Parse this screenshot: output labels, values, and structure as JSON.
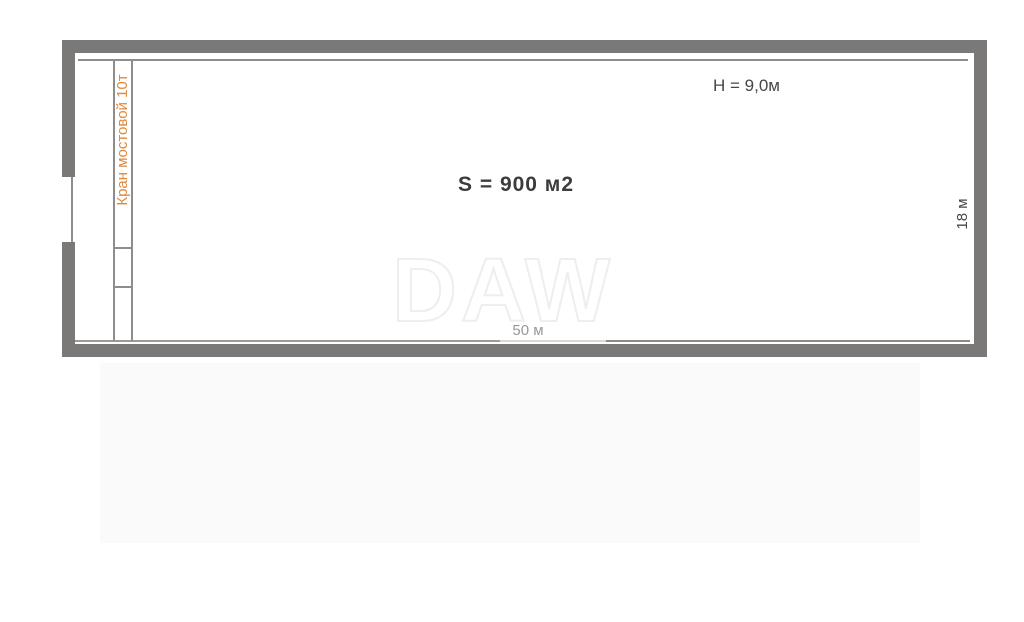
{
  "plan": {
    "crane_label": "Кран мостовой 10т",
    "height_label": "H = 9,0м",
    "area_label": "S = 900 м2",
    "width_label": "50 м",
    "depth_label": "18 м",
    "watermark": "DAW"
  },
  "colors": {
    "wall": "#7b7977",
    "line": "#8f8d8b",
    "line-light": "#d9d8d6",
    "accent": "#e0883c",
    "text-dark": "#474747",
    "text-gray": "#97989a",
    "watermark-stroke": "#efeeed",
    "shade": "#fbfafa"
  }
}
